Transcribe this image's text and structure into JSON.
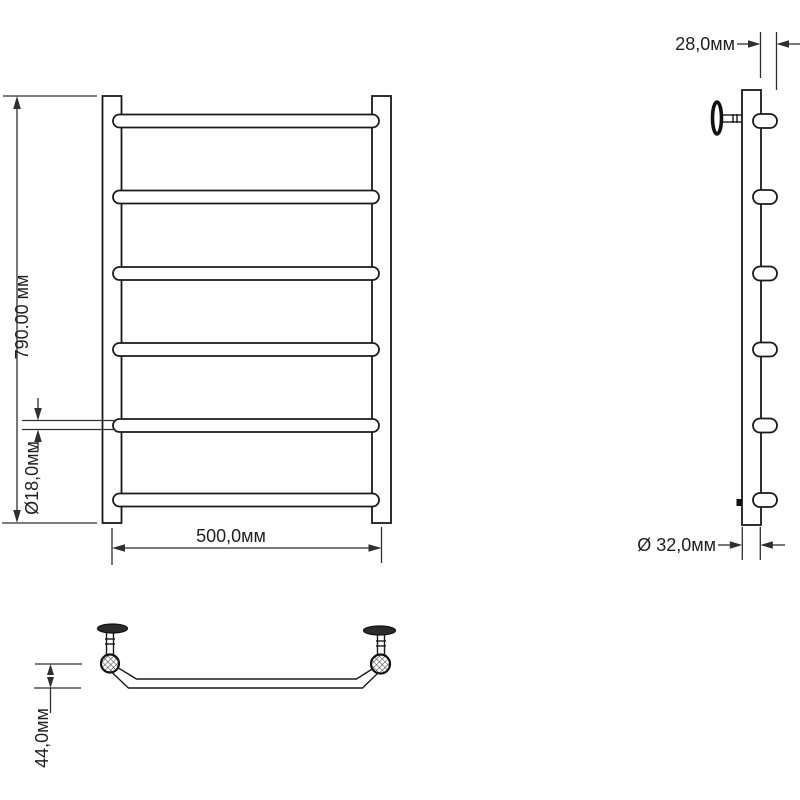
{
  "drawing": {
    "product": "ladder-towel-rail-dimension-drawing",
    "front_view": {
      "rung_count": 6,
      "height_dim": "790.00 мм",
      "width_dim": "500,0мм",
      "bar_diameter_dim": "Ø18,0мм"
    },
    "side_view": {
      "rung_count": 6,
      "depth_dim": "28,0мм",
      "tube_diameter_dim": "Ø 32,0мм"
    },
    "bottom_view": {
      "offset_dim": "44,0мм"
    },
    "colors": {
      "background": "#ffffff",
      "line": "#1a1a1a",
      "dimension": "#2f2f2f"
    }
  }
}
